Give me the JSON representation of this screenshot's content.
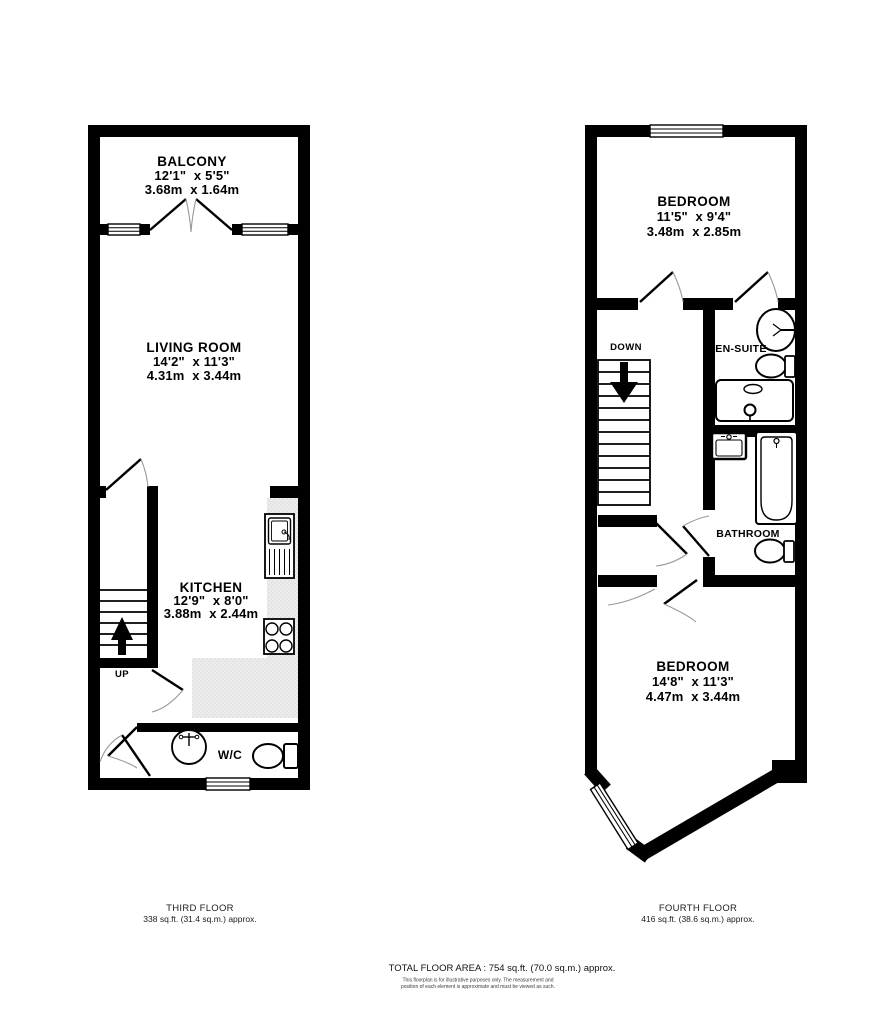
{
  "third": {
    "balcony": {
      "name": "BALCONY",
      "imperial": "12'1\"  x 5'5\"",
      "metric": "3.68m  x 1.64m"
    },
    "living_room": {
      "name": "LIVING ROOM",
      "imperial": "14'2\"  x 11'3\"",
      "metric": "4.31m  x 3.44m"
    },
    "kitchen": {
      "name": "KITCHEN",
      "imperial": "12'9\"  x 8'0\"",
      "metric": "3.88m  x 2.44m"
    },
    "wc_label": "W/C",
    "up_label": "UP",
    "caption_title": "THIRD FLOOR",
    "caption_area": "338 sq.ft. (31.4 sq.m.) approx."
  },
  "fourth": {
    "bedroom_front": {
      "name": "BEDROOM",
      "imperial": "11'5\"  x 9'4\"",
      "metric": "3.48m  x 2.85m"
    },
    "bedroom_back": {
      "name": "BEDROOM",
      "imperial": "14'8\"  x 11'3\"",
      "metric": "4.47m  x 3.44m"
    },
    "ensuite_label": "EN-SUITE",
    "bathroom_label": "BATHROOM",
    "down_label": "DOWN",
    "caption_title": "FOURTH FLOOR",
    "caption_area": "416 sq.ft. (38.6 sq.m.) approx."
  },
  "footer": {
    "total_area": "TOTAL FLOOR AREA : 754 sq.ft. (70.0 sq.m.) approx.",
    "disclaimer_line1": "This floorplan is for illustrative purposes only. The measurement and",
    "disclaimer_line2": "position of each element is approximate and must be viewed as such."
  },
  "colors": {
    "wall": "#000000",
    "counter": "#ededed",
    "door_arc": "#9a9a9a"
  }
}
